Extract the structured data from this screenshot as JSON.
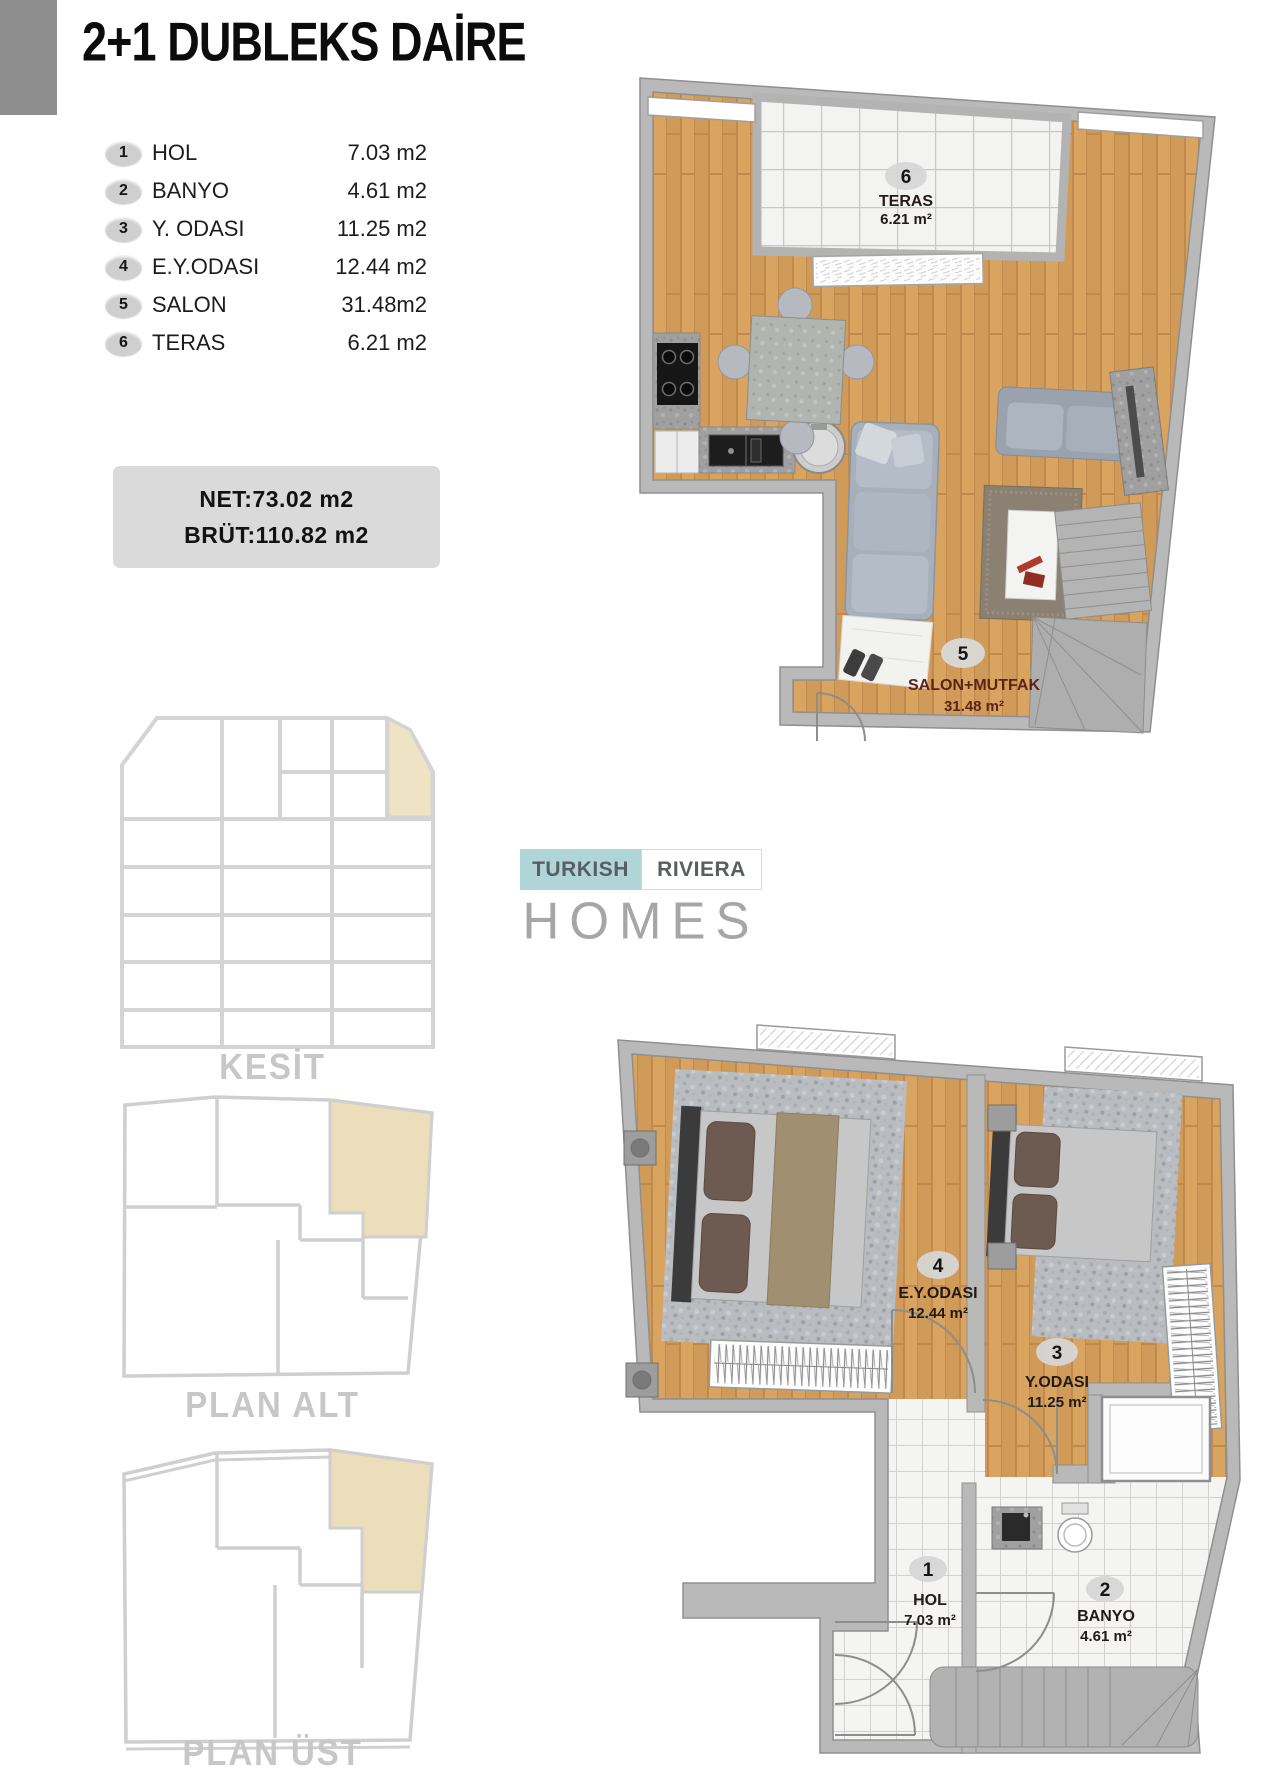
{
  "title": "2+1 DUBLEKS DAİRE",
  "legend": [
    {
      "num": "1",
      "label": "HOL",
      "area": "7.03 m2"
    },
    {
      "num": "2",
      "label": "BANYO",
      "area": "4.61 m2"
    },
    {
      "num": "3",
      "label": "Y. ODASI",
      "area": "11.25 m2"
    },
    {
      "num": "4",
      "label": "E.Y.ODASI",
      "area": "12.44 m2"
    },
    {
      "num": "5",
      "label": "SALON",
      "area": "31.48m2"
    },
    {
      "num": "6",
      "label": "TERAS",
      "area": "6.21 m2"
    }
  ],
  "summary": {
    "net": "NET:73.02 m2",
    "brut": "BRÜT:110.82 m2"
  },
  "sections": {
    "kesit": "KESİT",
    "plan_alt": "PLAN ALT",
    "plan_ust": "PLAN ÜST"
  },
  "watermark": {
    "word1": "TURKISH",
    "word2": "RIVIERA",
    "word3": "HOMES"
  },
  "upper_plan": {
    "rooms": [
      {
        "num": "6",
        "name": "TERAS",
        "area": "6.21 m²"
      },
      {
        "num": "5",
        "name": "SALON+MUTFAK",
        "area": "31.48 m²"
      }
    ]
  },
  "lower_plan": {
    "rooms": [
      {
        "num": "4",
        "name": "E.Y.ODASI",
        "area": "12.44 m²"
      },
      {
        "num": "3",
        "name": "Y.ODASI",
        "area": "11.25 m²"
      },
      {
        "num": "1",
        "name": "HOL",
        "area": "7.03 m²"
      },
      {
        "num": "2",
        "name": "BANYO",
        "area": "4.61 m²"
      }
    ]
  },
  "colors": {
    "accent_beige": "#ecddbb",
    "wall_gray": "#b9b9b9",
    "wood": "#d9a45f",
    "section_label_gray": "#c7c7c7",
    "logo_teal": "#b0d5d8",
    "salon_label_maroon": "#5b2418"
  }
}
